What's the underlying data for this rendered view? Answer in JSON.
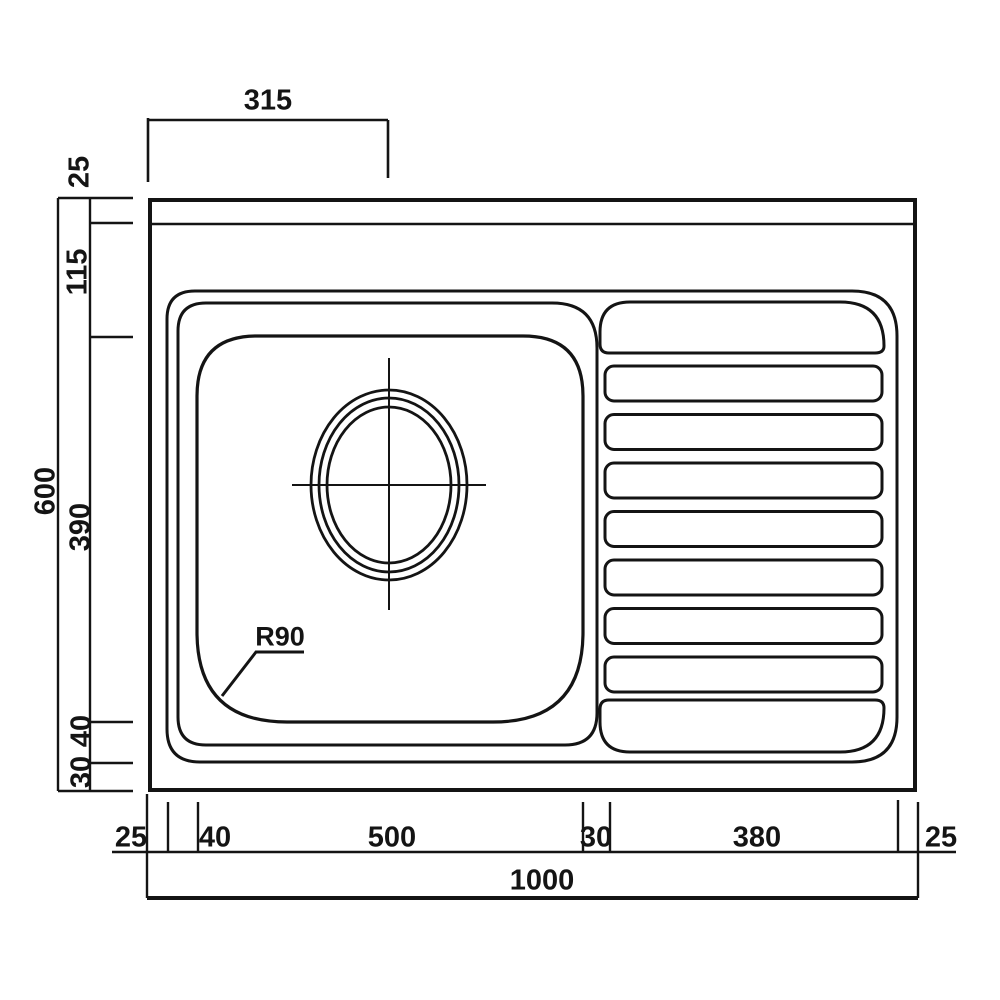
{
  "drawing": {
    "type": "technical-dimension-drawing",
    "subject": "single-bowl sink with right-hand drainer, top view"
  },
  "colors": {
    "line": "#141414",
    "background": "#ffffff"
  },
  "labels": {
    "top_drain_offset": "315",
    "left_rim": "25",
    "left_upper": "115",
    "left_overall": "600",
    "left_bowl": "390",
    "left_lower": "40",
    "left_bottom": "30",
    "bottom_left_edge": "25",
    "bottom_flange": "40",
    "bottom_bowl": "500",
    "bottom_divider": "30",
    "bottom_drainer": "380",
    "bottom_right_edge": "25",
    "bottom_overall": "1000",
    "radius": "R90"
  }
}
